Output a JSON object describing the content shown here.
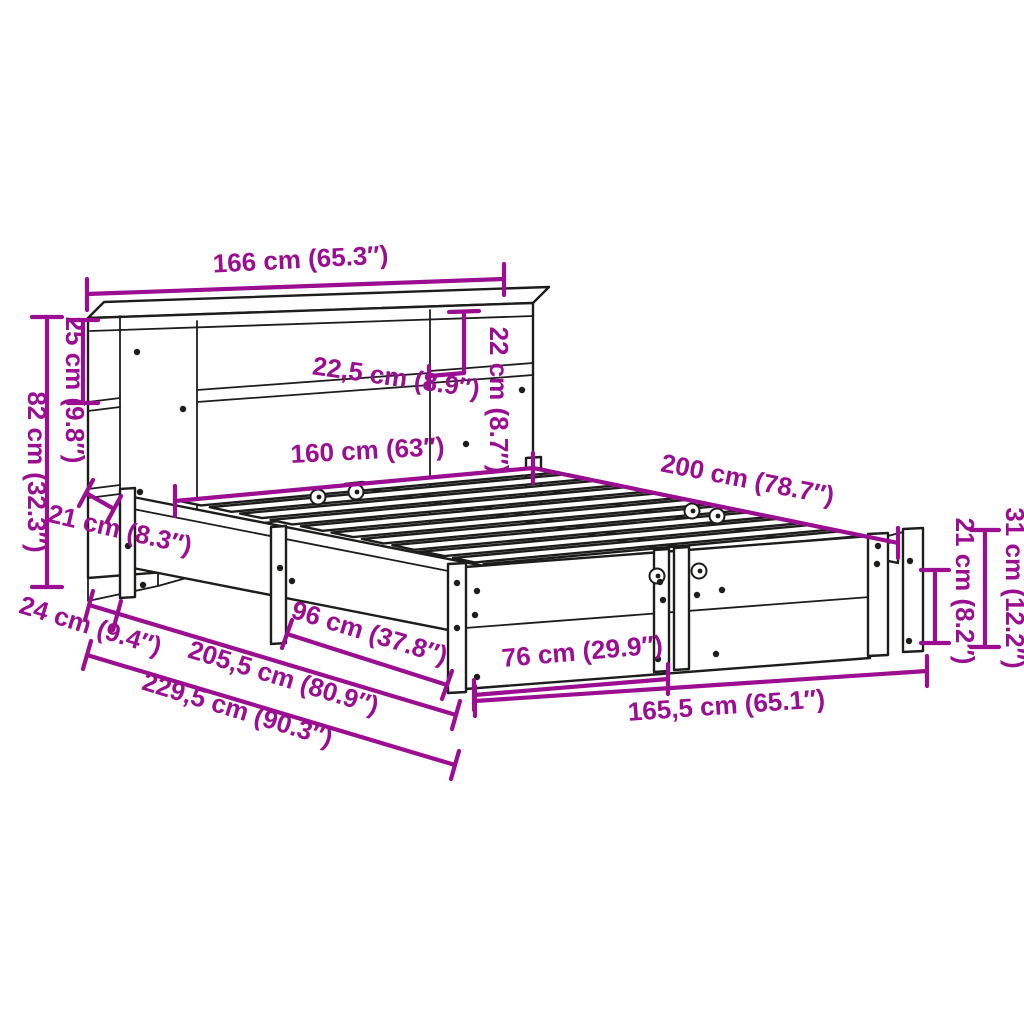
{
  "diagram": {
    "type": "product-dimension-diagram",
    "subject": "bookcase-bed-frame",
    "background_color": "#ffffff",
    "line_color": "#1d1d1b",
    "accent_color": "#9b0d91",
    "dimensions": {
      "headboard_width": {
        "label": "166 cm (65.3″)",
        "cm": "166",
        "in": "65.3"
      },
      "shelf_height": {
        "label": "25 cm (9.8″)",
        "cm": "25",
        "in": "9.8"
      },
      "headboard_height": {
        "label": "82 cm (32.3″)",
        "cm": "82",
        "in": "32.3"
      },
      "opening_height": {
        "label": "22 cm (8.7″)",
        "cm": "22",
        "in": "8.7"
      },
      "shelf_depth": {
        "label": "22,5 cm (8.9″)",
        "cm": "22,5",
        "in": "8.9"
      },
      "slat_area_width": {
        "label": "160 cm (63″)",
        "cm": "160",
        "in": "63"
      },
      "bed_length": {
        "label": "200 cm (78.7″)",
        "cm": "200",
        "in": "78.7"
      },
      "side_offset": {
        "label": "21 cm (8.3″)",
        "cm": "21",
        "in": "8.3"
      },
      "base_depth": {
        "label": "24 cm (9.4″)",
        "cm": "24",
        "in": "9.4"
      },
      "leg_spacing": {
        "label": "96 cm (37.8″)",
        "cm": "96",
        "in": "37.8"
      },
      "total_depth": {
        "label": "205,5 cm (80.9″)",
        "cm": "205,5",
        "in": "80.9"
      },
      "overall_depth": {
        "label": "229,5 cm (90.3″)",
        "cm": "229,5",
        "in": "90.3"
      },
      "foot_section": {
        "label": "76 cm (29.9″)",
        "cm": "76",
        "in": "29.9"
      },
      "frame_width": {
        "label": "165,5 cm (65.1″)",
        "cm": "165,5",
        "in": "65.1"
      },
      "rail_height": {
        "label": "21 cm (8.2″)",
        "cm": "21",
        "in": "8.2"
      },
      "frame_height": {
        "label": "31 cm (12.2″)",
        "cm": "31",
        "in": "12.2"
      }
    }
  }
}
